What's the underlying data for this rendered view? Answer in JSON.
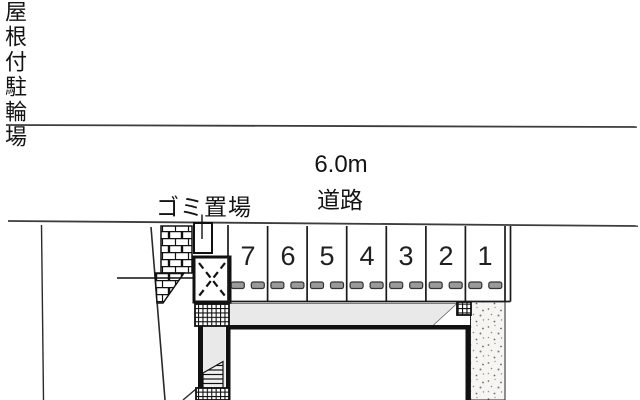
{
  "road": {
    "width_label": "6.0m",
    "name_label": "道路"
  },
  "labels": {
    "garbage_area": "ゴミ置場",
    "covered_bicycle_parking": "屋根付駐輪場"
  },
  "parking": {
    "stalls": [
      "7",
      "6",
      "5",
      "4",
      "3",
      "2",
      "1"
    ]
  },
  "icons": {
    "bicycle_shelter_marker": "dashed-x-box",
    "wheel_stop": "double-dash"
  },
  "colors": {
    "background": "#ffffff",
    "line_art": "#1a1a1a",
    "road_line": "#3c3c3c",
    "driveway_gray": "#e9e9e9",
    "wheel_stop_fill": "#9a9a9a",
    "gravel_bg": "#f6f5f1"
  }
}
